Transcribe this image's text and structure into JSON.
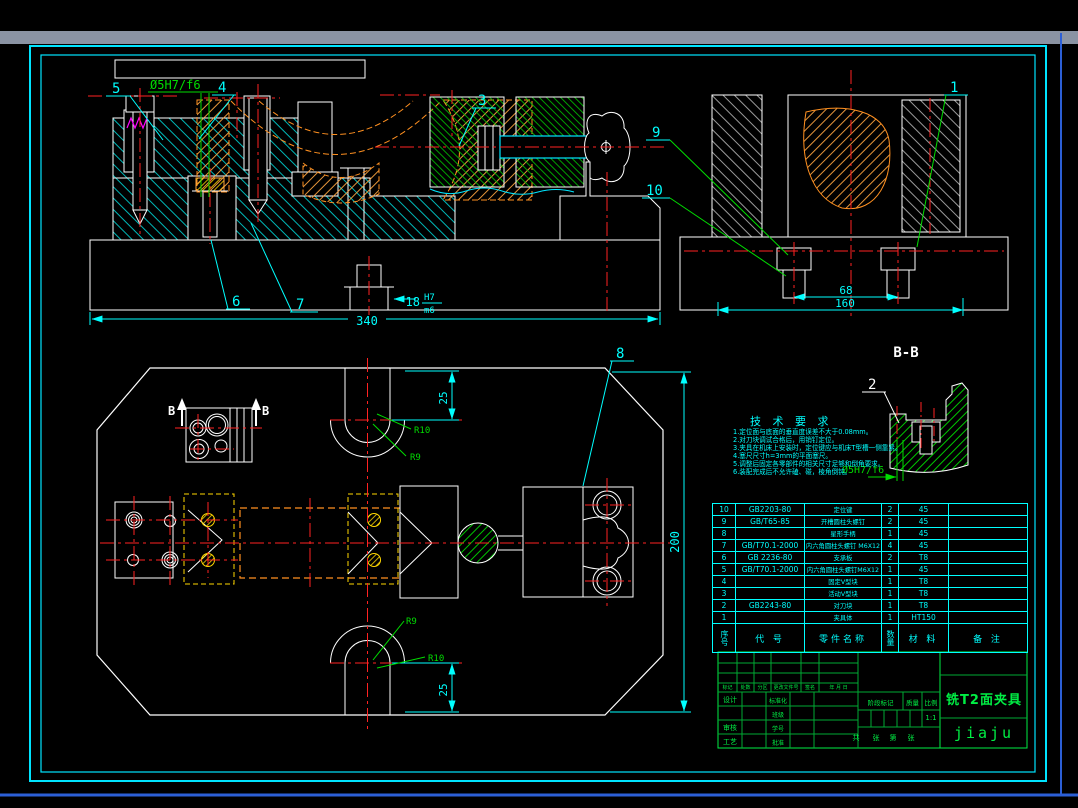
{
  "colors": {
    "background": "#000000",
    "frame_cyan": "#00e4ff",
    "top_band_gray": "#8a93a3",
    "window_blue": "#2c5fd6",
    "centerline_red": "#ff2222",
    "hatch_cyan": "#00cccc",
    "hatch_orange": "#ffa640",
    "hatch_green": "#00dd00",
    "hatch_yellow": "#ffd700",
    "dim_cyan": "#00ffff",
    "table_green": "#00ee44",
    "detail_magenta": "#ff00ff"
  },
  "drawing": {
    "balloons": [
      "1",
      "2",
      "3",
      "4",
      "5",
      "6",
      "7",
      "8",
      "9",
      "10"
    ],
    "dims": {
      "len340": "340",
      "slot18": "18",
      "fit_upper": "H7",
      "fit_lower": "m6",
      "key68": "68",
      "key160": "160",
      "slot25_top": "25",
      "slot25_bottom": "25",
      "height200": "200",
      "rad_top_outer": "R10",
      "rad_top_inner": "R9",
      "rad_bottom_inner": "R9",
      "rad_bottom_outer": "R10",
      "pin_fit_front": "Ø5H7/f6",
      "pin_fit_section": "Ø5H7/f6"
    },
    "section": {
      "label": "B-B",
      "arrow_left": "B",
      "arrow_right": "B"
    }
  },
  "tech_requirements": {
    "title": "技 术 要 求",
    "items": [
      "1.定位面与底面的垂直度误差不大于0.08mm。",
      "2.对刀块调试合格后，用销钉定位。",
      "3.夹具在机床上安装时，定位键应与机床T型槽一侧靠紧。",
      "4.塞尺尺寸h=3mm的平面塞尺。",
      "5.调整后固定各零部件的相关尺寸足够和倒角要求。",
      "6.装配完成后不允许磕、碰，棱角倒钝。"
    ]
  },
  "parts_table": {
    "headers": {
      "no": "序号",
      "code": "代 号",
      "name": "零件名称",
      "qty": "数量",
      "material": "材 料",
      "note": "备 注"
    },
    "rows": [
      {
        "no": "10",
        "code": "GB2203-80",
        "name": "定位键",
        "qty": "2",
        "material": "45",
        "note": ""
      },
      {
        "no": "9",
        "code": "GB/T65-85",
        "name": "开槽圆柱头螺钉",
        "qty": "2",
        "material": "45",
        "note": ""
      },
      {
        "no": "8",
        "code": "",
        "name": "星形手柄",
        "qty": "1",
        "material": "45",
        "note": ""
      },
      {
        "no": "7",
        "code": "GB/T70.1-2000",
        "name": "内六角圆柱头螺钉 M6X12",
        "qty": "4",
        "material": "45",
        "note": ""
      },
      {
        "no": "6",
        "code": "GB 2236-80",
        "name": "支承板",
        "qty": "2",
        "material": "T8",
        "note": ""
      },
      {
        "no": "5",
        "code": "GB/T70.1-2000",
        "name": "内六角圆柱头螺钉M6X12",
        "qty": "1",
        "material": "45",
        "note": ""
      },
      {
        "no": "4",
        "code": "",
        "name": "固定V型块",
        "qty": "1",
        "material": "T8",
        "note": ""
      },
      {
        "no": "3",
        "code": "",
        "name": "活动V型块",
        "qty": "1",
        "material": "T8",
        "note": ""
      },
      {
        "no": "2",
        "code": "GB2243-80",
        "name": "对刀块",
        "qty": "1",
        "material": "T8",
        "note": ""
      },
      {
        "no": "1",
        "code": "",
        "name": "夹具体",
        "qty": "1",
        "material": "HT150",
        "note": ""
      }
    ]
  },
  "title_block": {
    "revision_headers": [
      "标记",
      "处数",
      "分区",
      "更改文件号",
      "签名",
      "年 月 日"
    ],
    "left_labels": [
      "设计",
      "审核",
      "工艺"
    ],
    "mid_labels": [
      "标准化",
      "班级",
      "学号",
      "批准"
    ],
    "stage_label": "阶段标记",
    "mass_label": "质量",
    "scale_label": "比例",
    "scale_value": "1:1",
    "sheet_labels": [
      "共",
      "张",
      "第",
      "张"
    ],
    "drawing_title": "铣T2面夹具",
    "drawing_code": "jiaju"
  }
}
